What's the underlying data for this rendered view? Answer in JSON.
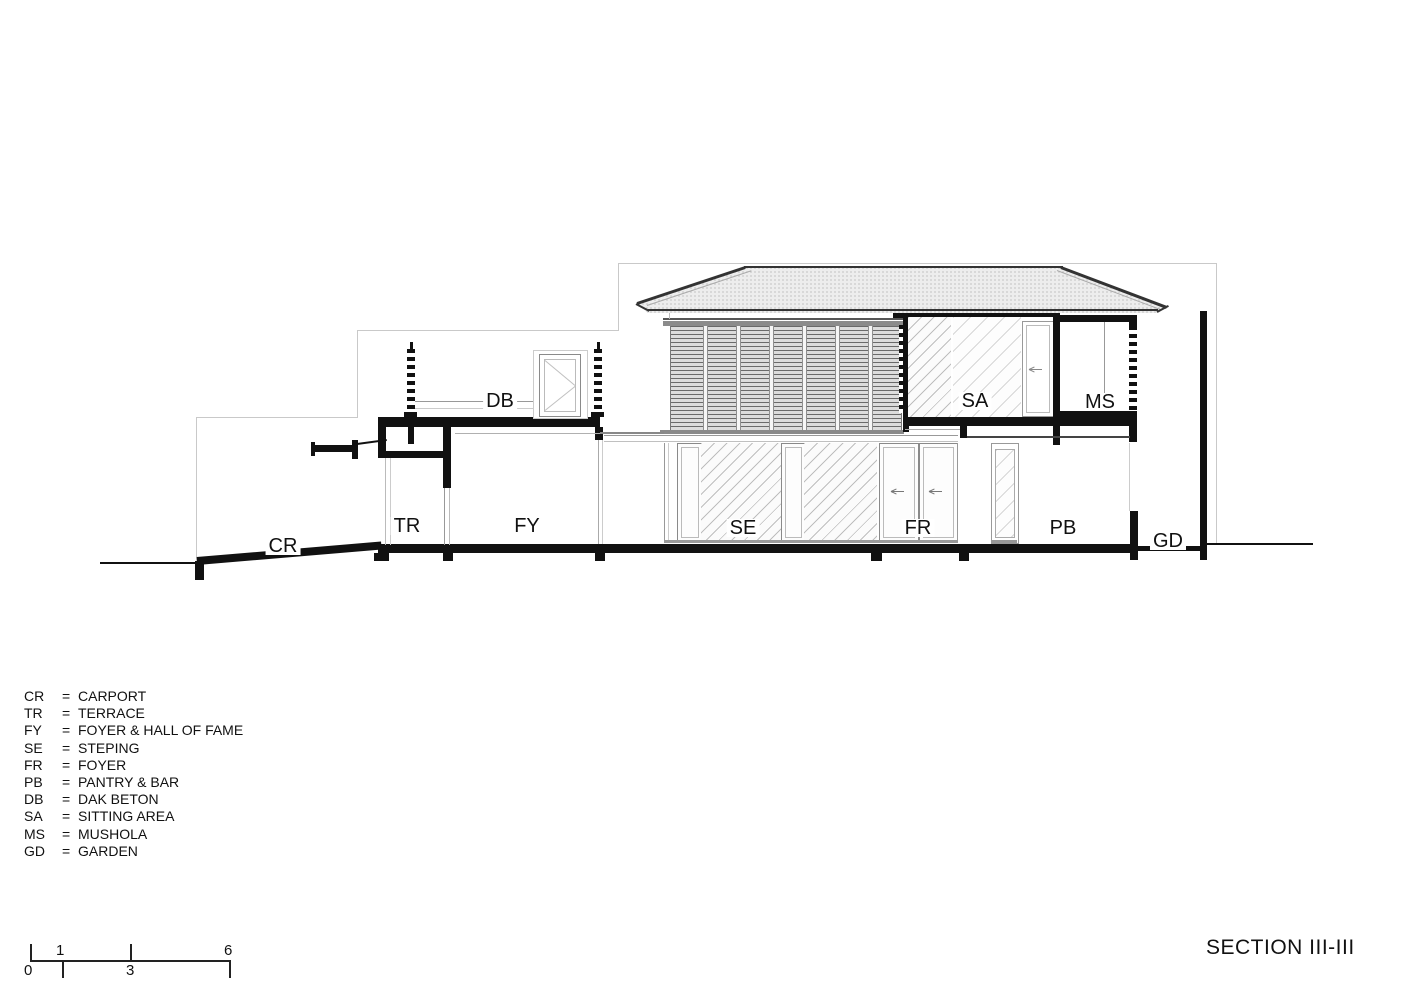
{
  "drawing": {
    "title": "SECTION III-III",
    "rooms": {
      "cr": "CR",
      "tr": "TR",
      "fy": "FY",
      "se": "SE",
      "fr": "FR",
      "pb": "PB",
      "gd": "GD",
      "db": "DB",
      "sa": "SA",
      "ms": "MS"
    }
  },
  "legend": {
    "separator": "=",
    "items": [
      {
        "abbr": "CR",
        "name": "CARPORT"
      },
      {
        "abbr": "TR",
        "name": "TERRACE"
      },
      {
        "abbr": "FY",
        "name": "FOYER & HALL OF FAME"
      },
      {
        "abbr": "SE",
        "name": "STEPING"
      },
      {
        "abbr": "FR",
        "name": "FOYER"
      },
      {
        "abbr": "PB",
        "name": "PANTRY & BAR"
      },
      {
        "abbr": "DB",
        "name": "DAK BETON"
      },
      {
        "abbr": "SA",
        "name": "SITTING AREA"
      },
      {
        "abbr": "MS",
        "name": "MUSHOLA"
      },
      {
        "abbr": "GD",
        "name": "GARDEN"
      }
    ]
  },
  "scale_bar": {
    "labels": [
      "0",
      "1",
      "3",
      "6"
    ]
  }
}
